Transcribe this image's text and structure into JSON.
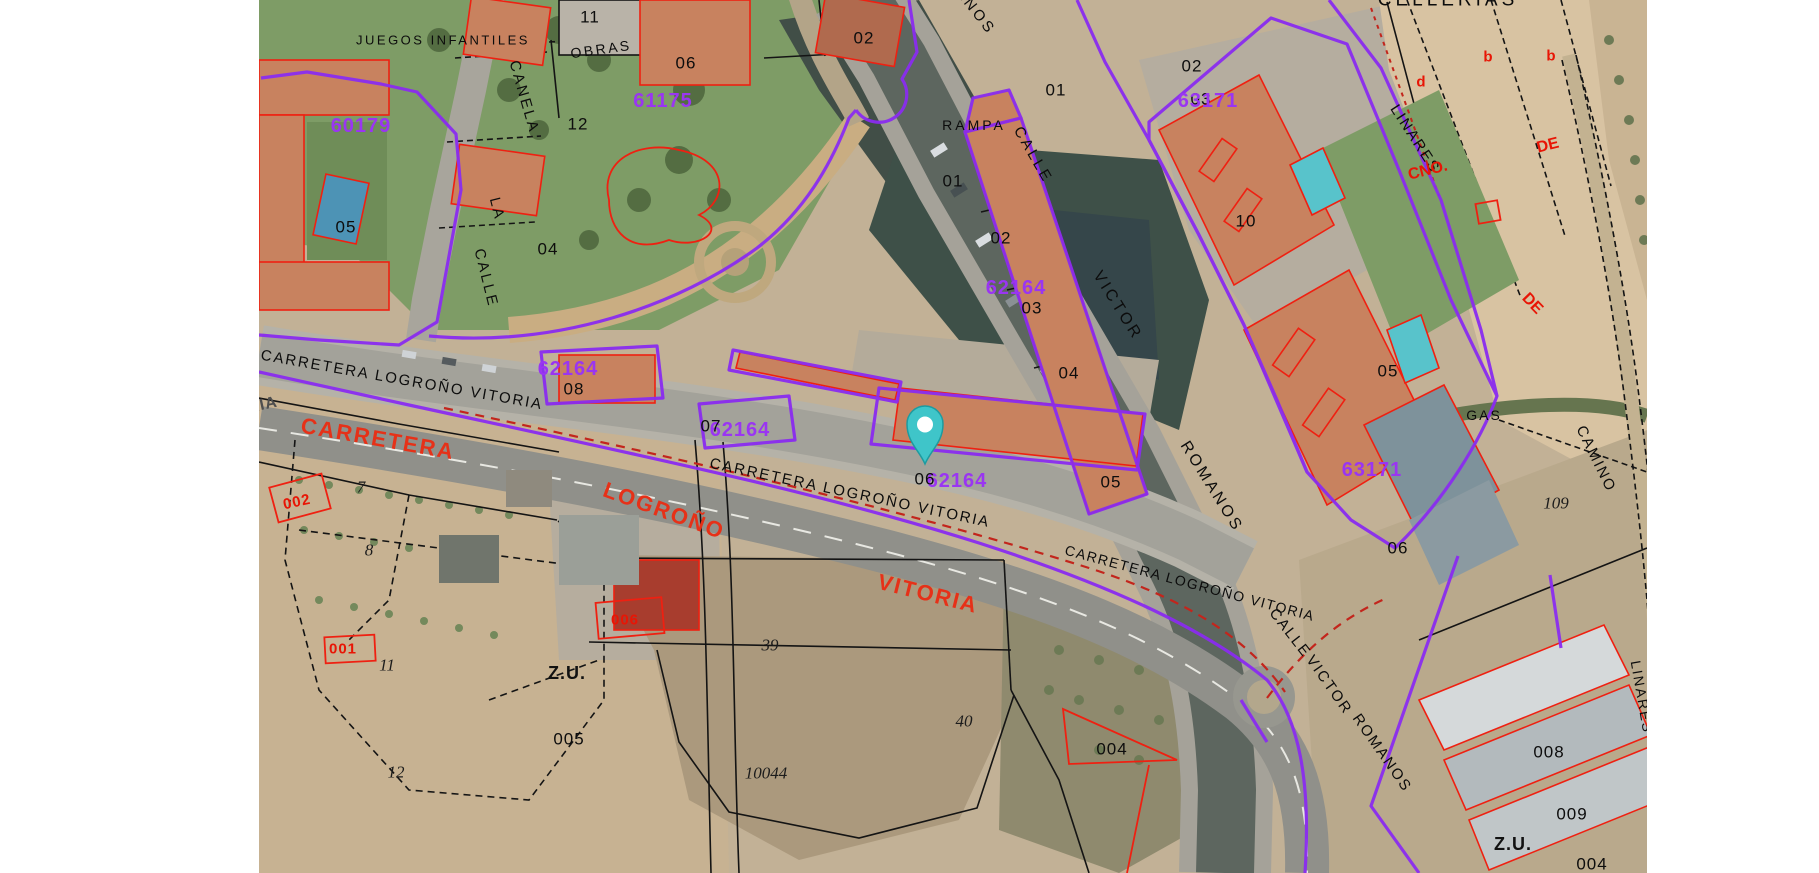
{
  "map": {
    "left": 259,
    "width": 1388,
    "height": 873,
    "type": "cadastral-aerial"
  },
  "colors": {
    "parcel_boundary_purple": "#8a2cf0",
    "parcel_code_purple": "#9a35f2",
    "building_outline_red": "#ef2011",
    "road_text_red": "#e63118",
    "cadastre_black": "#141414",
    "pin_teal": "#3fc5c9",
    "margin_white": "#ffffff"
  },
  "pin": {
    "x": 925,
    "y": 471,
    "color": "#3fc5c9",
    "name": "location-pin"
  },
  "labels": [
    {
      "t": "JUEGOS INFANTILES",
      "x": 443,
      "y": 40,
      "r": 0,
      "k": "street",
      "s": 13,
      "ls": 2.5
    },
    {
      "t": "OBRAS",
      "x": 601,
      "y": 49,
      "r": -8,
      "k": "street",
      "s": 14
    },
    {
      "t": "11",
      "x": 590,
      "y": 17,
      "k": "num"
    },
    {
      "t": "CANELA",
      "x": 524,
      "y": 97,
      "r": 74,
      "k": "street"
    },
    {
      "t": "LA",
      "x": 497,
      "y": 209,
      "r": 76,
      "k": "street"
    },
    {
      "t": "CALLE",
      "x": 486,
      "y": 278,
      "r": 76,
      "k": "street"
    },
    {
      "t": "06",
      "x": 686,
      "y": 63,
      "k": "num"
    },
    {
      "t": "61175",
      "x": 663,
      "y": 101,
      "k": "pcode"
    },
    {
      "t": "60179",
      "x": 361,
      "y": 126,
      "k": "pcode"
    },
    {
      "t": "12",
      "x": 578,
      "y": 124,
      "k": "num"
    },
    {
      "t": "05",
      "x": 346,
      "y": 227,
      "k": "num"
    },
    {
      "t": "04",
      "x": 548,
      "y": 249,
      "k": "num"
    },
    {
      "t": "02",
      "x": 864,
      "y": 38,
      "k": "num"
    },
    {
      "t": "ROMANOS",
      "x": 962,
      "y": -6,
      "r": 52,
      "k": "street",
      "ls": 3
    },
    {
      "t": "RAMPA",
      "x": 974,
      "y": 125,
      "k": "street",
      "s": 14,
      "ls": 3
    },
    {
      "t": "CALLE",
      "x": 1033,
      "y": 155,
      "r": 60,
      "k": "street",
      "ls": 3
    },
    {
      "t": "01",
      "x": 953,
      "y": 181,
      "k": "num"
    },
    {
      "t": "01",
      "x": 1056,
      "y": 90,
      "k": "num"
    },
    {
      "t": "02",
      "x": 1001,
      "y": 238,
      "k": "num"
    },
    {
      "t": "62164",
      "x": 1016,
      "y": 288,
      "k": "pcode"
    },
    {
      "t": "03",
      "x": 1032,
      "y": 308,
      "k": "num"
    },
    {
      "t": "04",
      "x": 1069,
      "y": 373,
      "k": "num"
    },
    {
      "t": "05",
      "x": 1111,
      "y": 482,
      "k": "num"
    },
    {
      "t": "VICTOR",
      "x": 1117,
      "y": 306,
      "r": 58,
      "k": "street",
      "s": 16,
      "ls": 3
    },
    {
      "t": "ROMANOS",
      "x": 1211,
      "y": 487,
      "r": 58,
      "k": "street",
      "s": 16,
      "ls": 3
    },
    {
      "t": "02",
      "x": 1192,
      "y": 66,
      "k": "num"
    },
    {
      "t": "03",
      "x": 1201,
      "y": 99,
      "k": "num"
    },
    {
      "t": "63171",
      "x": 1208,
      "y": 101,
      "k": "pcode"
    },
    {
      "t": "10",
      "x": 1246,
      "y": 221,
      "k": "num"
    },
    {
      "t": "d",
      "x": 1421,
      "y": 82,
      "k": "rsmall"
    },
    {
      "t": "b",
      "x": 1488,
      "y": 57,
      "k": "rsmall"
    },
    {
      "t": "b",
      "x": 1551,
      "y": 56,
      "k": "rsmall"
    },
    {
      "t": "LINARES",
      "x": 1415,
      "y": 139,
      "r": 57,
      "k": "street",
      "s": 15,
      "ls": 2
    },
    {
      "t": "CNO.",
      "x": 1428,
      "y": 171,
      "r": -14,
      "k": "rsmall",
      "s": 16
    },
    {
      "t": "DE",
      "x": 1548,
      "y": 146,
      "r": -14,
      "k": "rsmall",
      "s": 16
    },
    {
      "t": "DE",
      "x": 1532,
      "y": 304,
      "r": 46,
      "k": "rsmall",
      "s": 16
    },
    {
      "t": "CELLERIAS",
      "x": 1448,
      "y": 0,
      "r": 0,
      "k": "street",
      "s": 19,
      "ls": 4
    },
    {
      "t": "CAMINO",
      "x": 1596,
      "y": 459,
      "r": 64,
      "k": "street",
      "s": 15,
      "ls": 2
    },
    {
      "t": "109",
      "x": 1556,
      "y": 503,
      "k": "numit"
    },
    {
      "t": "05",
      "x": 1388,
      "y": 371,
      "k": "num"
    },
    {
      "t": "GAS",
      "x": 1484,
      "y": 415,
      "k": "street",
      "s": 14,
      "ls": 2
    },
    {
      "t": "63171",
      "x": 1372,
      "y": 470,
      "k": "pcode"
    },
    {
      "t": "06",
      "x": 1398,
      "y": 548,
      "k": "num"
    },
    {
      "t": "62164",
      "x": 568,
      "y": 369,
      "k": "pcode"
    },
    {
      "t": "08",
      "x": 574,
      "y": 389,
      "k": "num"
    },
    {
      "t": "62164",
      "x": 740,
      "y": 430,
      "k": "pcode"
    },
    {
      "t": "07",
      "x": 711,
      "y": 426,
      "k": "num"
    },
    {
      "t": "62164",
      "x": 957,
      "y": 481,
      "k": "pcode"
    },
    {
      "t": "06",
      "x": 925,
      "y": 479,
      "k": "num"
    },
    {
      "t": "CARRETERA LOGROÑO VITORIA",
      "x": 402,
      "y": 380,
      "r": 10,
      "k": "street",
      "s": 15,
      "ls": 2
    },
    {
      "t": "CARRETERA LOGROÑO VITORIA",
      "x": 850,
      "y": 493,
      "r": 12,
      "k": "street",
      "s": 15,
      "ls": 2
    },
    {
      "t": "CARRETERA LOGROÑO VITORIA",
      "x": 1190,
      "y": 583,
      "r": 15,
      "k": "street",
      "s": 14,
      "ls": 1.5
    },
    {
      "t": "CALLE",
      "x": 1290,
      "y": 633,
      "r": 52,
      "k": "street",
      "s": 15,
      "ls": 2
    },
    {
      "t": "VICTOR",
      "x": 1329,
      "y": 685,
      "r": 55,
      "k": "street",
      "s": 15,
      "ls": 2
    },
    {
      "t": "ROMANOS",
      "x": 1382,
      "y": 753,
      "r": 55,
      "k": "street",
      "s": 15,
      "ls": 2
    },
    {
      "t": "ORIA",
      "x": 256,
      "y": 407,
      "r": -12,
      "k": "grey"
    },
    {
      "t": "CARRETERA",
      "x": 378,
      "y": 439,
      "r": 10,
      "k": "rtext"
    },
    {
      "t": "LOGROÑO",
      "x": 664,
      "y": 511,
      "r": 20,
      "k": "rtext"
    },
    {
      "t": "VITORIA",
      "x": 928,
      "y": 594,
      "r": 14,
      "k": "rtext"
    },
    {
      "t": "002",
      "x": 297,
      "y": 502,
      "r": -12,
      "k": "rnum"
    },
    {
      "t": "7",
      "x": 361,
      "y": 487,
      "k": "numit"
    },
    {
      "t": "8",
      "x": 369,
      "y": 550,
      "k": "numit"
    },
    {
      "t": "001",
      "x": 343,
      "y": 649,
      "k": "rnum"
    },
    {
      "t": "11",
      "x": 387,
      "y": 665,
      "k": "numit"
    },
    {
      "t": "12",
      "x": 396,
      "y": 772,
      "k": "numit"
    },
    {
      "t": "006",
      "x": 625,
      "y": 620,
      "k": "rnum"
    },
    {
      "t": "Z.U.",
      "x": 567,
      "y": 673,
      "k": "zu"
    },
    {
      "t": "005",
      "x": 569,
      "y": 739,
      "k": "num"
    },
    {
      "t": "39",
      "x": 770,
      "y": 645,
      "k": "numit"
    },
    {
      "t": "10044",
      "x": 766,
      "y": 773,
      "k": "numit"
    },
    {
      "t": "40",
      "x": 964,
      "y": 721,
      "k": "numit"
    },
    {
      "t": "004",
      "x": 1112,
      "y": 749,
      "k": "num"
    },
    {
      "t": "008",
      "x": 1549,
      "y": 752,
      "k": "num"
    },
    {
      "t": "009",
      "x": 1572,
      "y": 814,
      "k": "num"
    },
    {
      "t": "Z.U.",
      "x": 1513,
      "y": 844,
      "k": "zu"
    },
    {
      "t": "004",
      "x": 1592,
      "y": 864,
      "k": "num"
    },
    {
      "t": "LINARES",
      "x": 1642,
      "y": 697,
      "r": 80,
      "k": "street",
      "s": 14,
      "ls": 2
    }
  ]
}
